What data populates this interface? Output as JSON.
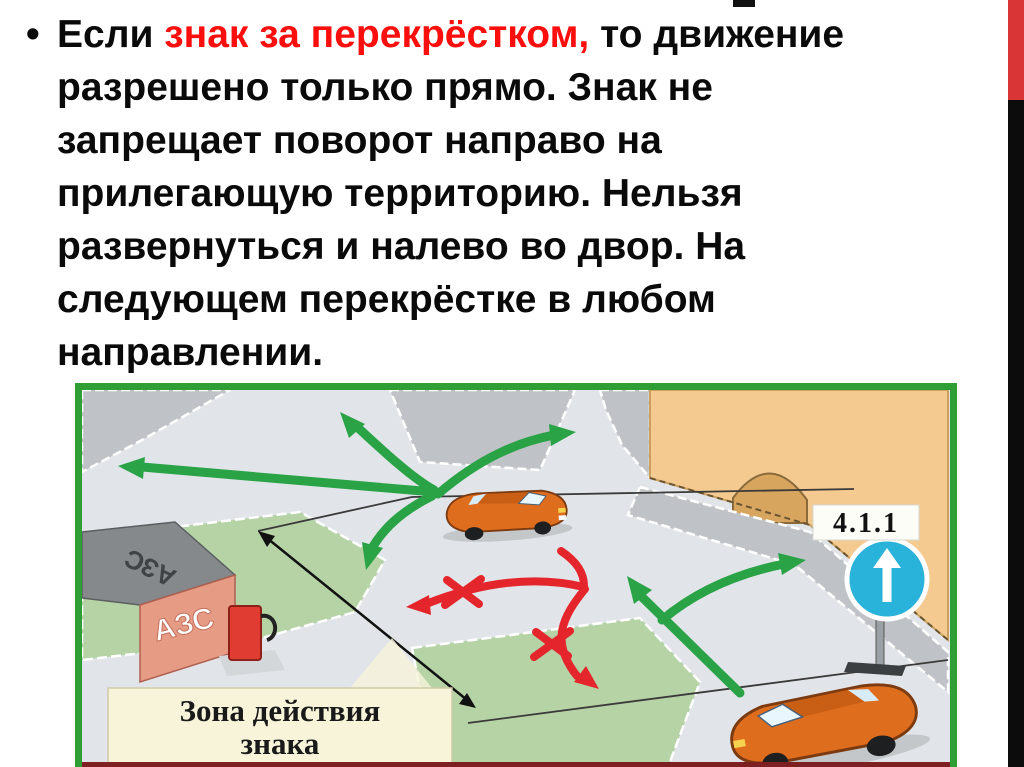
{
  "slide": {
    "bullet_glyph": "•",
    "text_part1": "Если ",
    "text_part2_red": "знак за перекрёстком,",
    "text_part3": " то движение\nразрешено только прямо. Знак не\nзапрещает поворот направо на\nприлегающую территорию. Нельзя\nразвернуться и налево во двор. На\nследующем перекрёстке в любом\nнаправлении."
  },
  "diagram": {
    "sign_code": "4.1.1",
    "station_roof_label": "АЗС",
    "station_wall_label": "АЗС",
    "zone_label_line1": "Зона действия",
    "zone_label_line2": "знака"
  },
  "colors": {
    "text_red": "#fb0e0c",
    "bar_red": "#d93436",
    "frame_green": "#2f9e35",
    "road": "#e1e5e9",
    "sidewalk": "#bfc2c6",
    "grass": "#b5d3a5",
    "building_tan": "#f4ca90",
    "arch_tan": "#d8a55f",
    "sign_blue": "#29b2da",
    "green_arrow": "#2aa347",
    "red_arrow": "#e4262c",
    "pump_red": "#e03c31",
    "label_cream": "#f7f4da",
    "station_wall": "#e69b84",
    "station_roof": "#85898c",
    "car_orange": "#df6d1e",
    "bottom_strip": "#7e2022"
  }
}
